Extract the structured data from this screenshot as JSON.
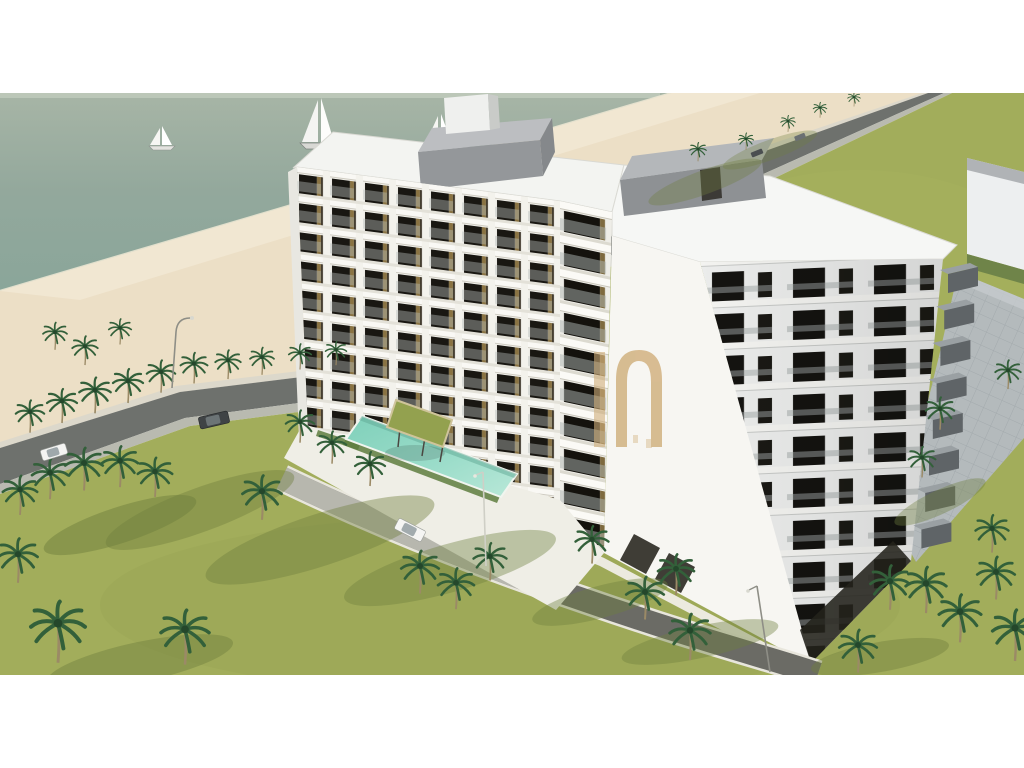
{
  "scene": {
    "type": "3d-architectural-rendering",
    "subject": "Aerial rendering of a white beachfront apartment complex with balconies, swimming pool, palm trees, coastal road and sea with sailboats",
    "watermark": {
      "visible_text": "n",
      "color": "#cfae79"
    },
    "environment": {
      "sailboats": 3,
      "cars": 5,
      "street_lamps": 3,
      "palm_trees": 45,
      "swimming_pools": 1
    },
    "building": {
      "left_wing_floor_rows": 9,
      "tower_window_rows": 7,
      "tower_edge_balconies": 8
    },
    "colors": {
      "water": "#93a89c",
      "sand": "#ecdfc6",
      "road": "#6e716d",
      "lawn": "#a2ad5b",
      "building_white": "#f4f3ee",
      "glass_dark": "#191712",
      "bronze_accent": "#8a7342",
      "balcony_gray": "#63686b",
      "pool_water": "#8fd7c2",
      "paver_gray": "#b4babc",
      "frame_white": "#ffffff"
    }
  }
}
